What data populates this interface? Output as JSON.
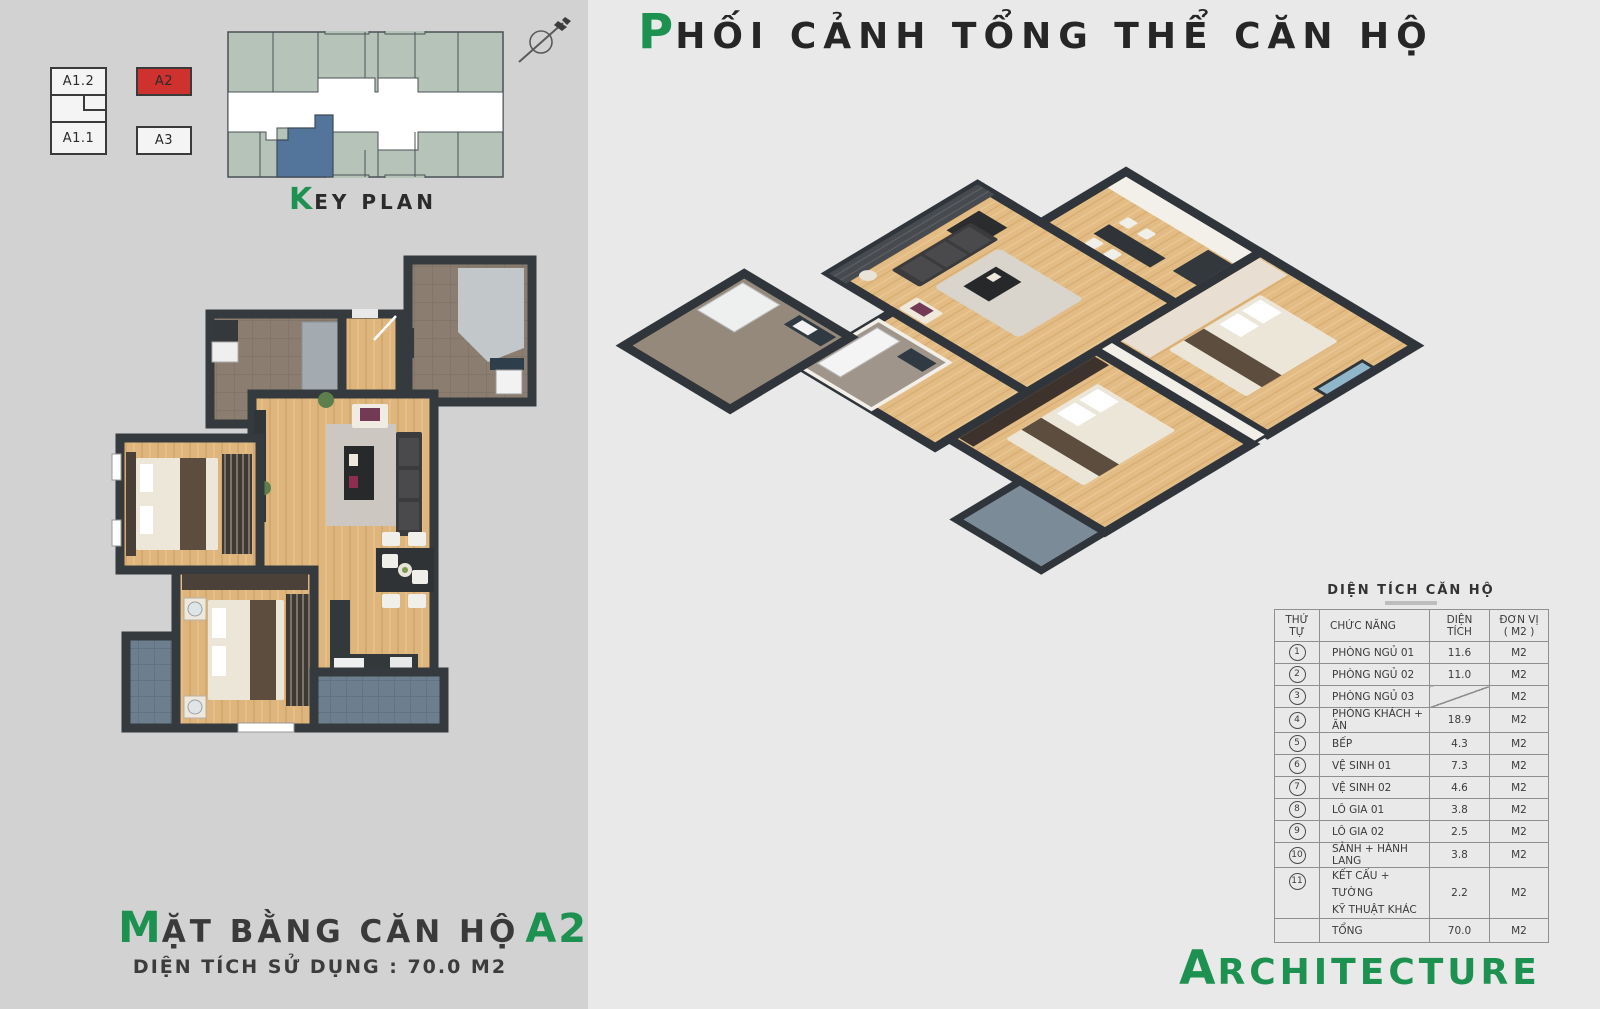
{
  "colors": {
    "accent_green": "#1d9150",
    "highlight_red": "#ce312e",
    "keyplan_unit_fill": "#b5c3b9",
    "keyplan_selected_fill": "#53759b",
    "left_panel_bg": "#d2d2d2",
    "right_panel_bg": "#e9e9e9",
    "wall_dark": "#343a3d"
  },
  "icons": {
    "north": "north-arrow-icon"
  },
  "key_plan": {
    "caption_initial": "K",
    "caption_rest": "EY PLAN",
    "legend": [
      {
        "label": "A1.2"
      },
      {
        "label": "A2"
      },
      {
        "label": "A1.1"
      },
      {
        "label": "A3"
      }
    ]
  },
  "perspective": {
    "title_initial": "P",
    "title_rest": "HỐI CẢNH TỔNG THỂ CĂN HỘ"
  },
  "floor_plan": {
    "title_initial": "M",
    "title_rest": "ẶT BẰNG CĂN HỘ",
    "unit_code": "A2-11",
    "subtitle": "DIỆN TÍCH SỬ DỤNG : 70.0 M2"
  },
  "area_table": {
    "title": "DIỆN TÍCH CĂN HỘ",
    "headers": {
      "col1": "THỨ TỰ",
      "col2": "CHỨC NĂNG",
      "col3": "DIỆN TÍCH",
      "col4_line1": "ĐƠN VỊ",
      "col4_line2": "( M2 )"
    },
    "rows": [
      {
        "no": "1",
        "name": "PHÒNG NGỦ 01",
        "area": "11.6",
        "unit": "M2"
      },
      {
        "no": "2",
        "name": "PHÒNG NGỦ 02",
        "area": "11.0",
        "unit": "M2"
      },
      {
        "no": "3",
        "name": "PHÒNG NGỦ 03",
        "area": "",
        "unit": "M2"
      },
      {
        "no": "4",
        "name": "PHÒNG KHÁCH + ĂN",
        "area": "18.9",
        "unit": "M2"
      },
      {
        "no": "5",
        "name": "BẾP",
        "area": "4.3",
        "unit": "M2"
      },
      {
        "no": "6",
        "name": "VỆ SINH 01",
        "area": "7.3",
        "unit": "M2"
      },
      {
        "no": "7",
        "name": "VỆ SINH 02",
        "area": "4.6",
        "unit": "M2"
      },
      {
        "no": "8",
        "name": "LÔ GIA 01",
        "area": "3.8",
        "unit": "M2"
      },
      {
        "no": "9",
        "name": "LÔ GIA 02",
        "area": "2.5",
        "unit": "M2"
      },
      {
        "no": "10",
        "name": "SẢNH + HÀNH LANG",
        "area": "3.8",
        "unit": "M2"
      },
      {
        "no": "11",
        "name": "KẾT CẤU + TƯỜNG",
        "name2": "KỸ THUẬT KHÁC",
        "area": "2.2",
        "unit": "M2"
      }
    ],
    "total": {
      "name": "TỔNG",
      "area": "70.0",
      "unit": "M2"
    }
  },
  "branding": {
    "initial": "A",
    "rest": "RCHITECTURE"
  }
}
